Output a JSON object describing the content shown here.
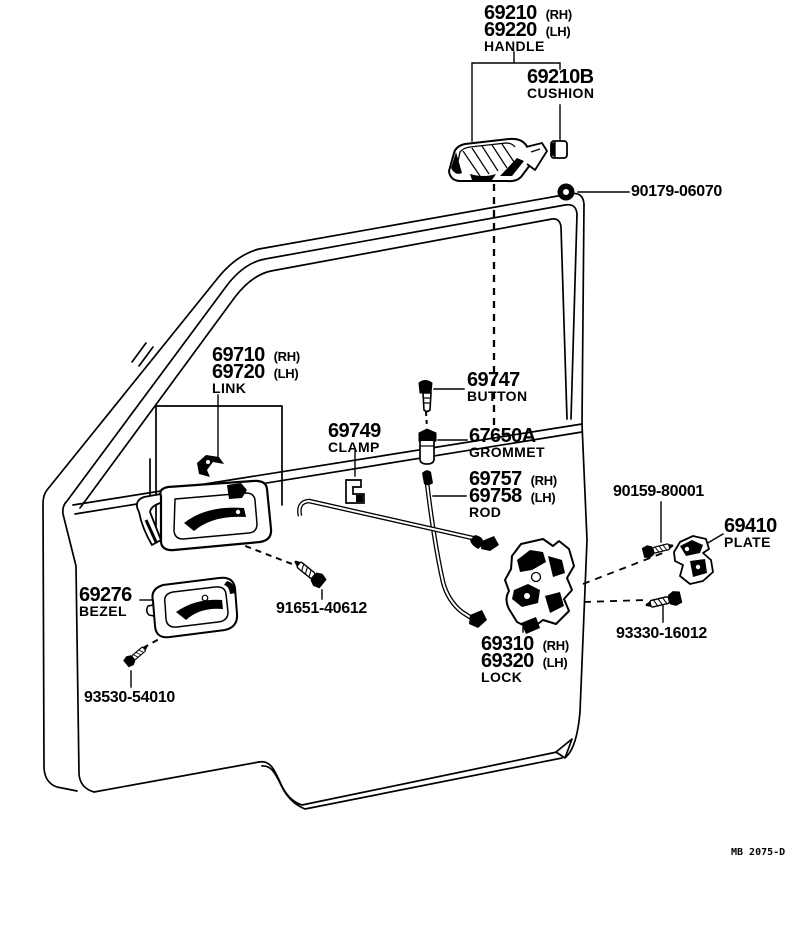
{
  "figure": {
    "code": "MB 2075-D"
  },
  "parts": {
    "handle": {
      "num1": "69210",
      "qual1": "(RH)",
      "num2": "69220",
      "qual2": "(LH)",
      "label": "HANDLE"
    },
    "cushion": {
      "num": "69210B",
      "label": "CUSHION"
    },
    "handle_nut": {
      "num": "90179-06070"
    },
    "link": {
      "num1": "69710",
      "qual1": "(RH)",
      "num2": "69720",
      "qual2": "(LH)",
      "label": "LINK"
    },
    "button": {
      "num": "69747",
      "label": "BUTTON"
    },
    "clamp": {
      "num": "69749",
      "label": "CLAMP"
    },
    "grommet": {
      "num": "67650A",
      "label": "GROMMET"
    },
    "rod": {
      "num1": "69757",
      "qual1": "(RH)",
      "num2": "69758",
      "qual2": "(LH)",
      "label": "ROD"
    },
    "plate_screw": {
      "num": "90159-80001"
    },
    "plate": {
      "num": "69410",
      "label": "PLATE"
    },
    "bezel": {
      "num": "69276",
      "label": "BEZEL"
    },
    "link_screw": {
      "num": "91651-40612"
    },
    "lock_screw": {
      "num": "93330-16012"
    },
    "lock": {
      "num1": "69310",
      "qual1": "(RH)",
      "num2": "69320",
      "qual2": "(LH)",
      "label": "LOCK"
    },
    "bezel_screw": {
      "num": "93530-54010"
    }
  },
  "colors": {
    "ink": "#000000",
    "paper": "#ffffff"
  }
}
